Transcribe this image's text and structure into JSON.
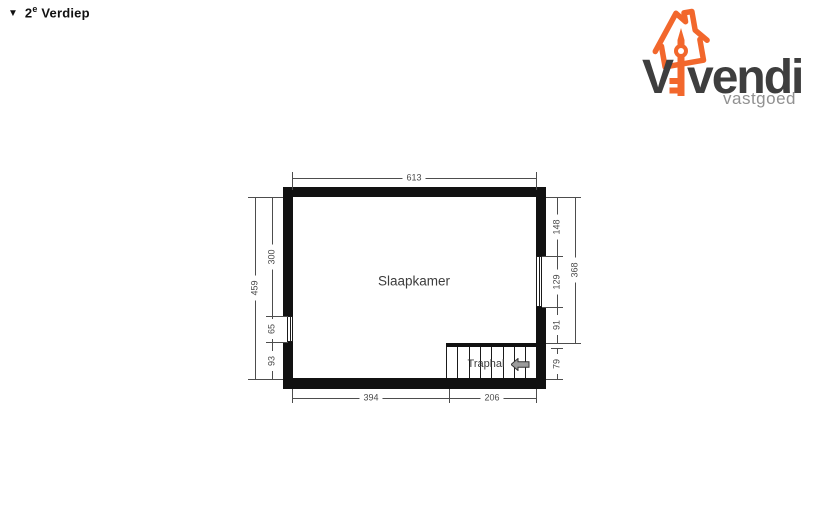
{
  "header": {
    "marker": "▼",
    "floor_number": "2",
    "floor_sup": "e",
    "floor_name": " Verdiep"
  },
  "logo": {
    "brand_v": "V",
    "brand_rest": "vendi",
    "subtitle": "vastgoed"
  },
  "colors": {
    "wall": "#111111",
    "dimension_line": "#4d4d4d",
    "logo_orange": "#f2672c",
    "logo_charcoal": "#3e3e3e",
    "logo_gray": "#919191",
    "arrow_fill": "#9c9c9c"
  },
  "plan": {
    "rooms": [
      {
        "name": "Slaapkamer"
      },
      {
        "name": "Traphal"
      }
    ],
    "dimensions": {
      "top": "613",
      "bottom_left": "394",
      "bottom_right": "206",
      "left_outer": "459",
      "left_segments": [
        "300",
        "65",
        "93"
      ],
      "right_outer": "368",
      "right_segments": [
        "148",
        "129",
        "91",
        "79"
      ]
    }
  }
}
